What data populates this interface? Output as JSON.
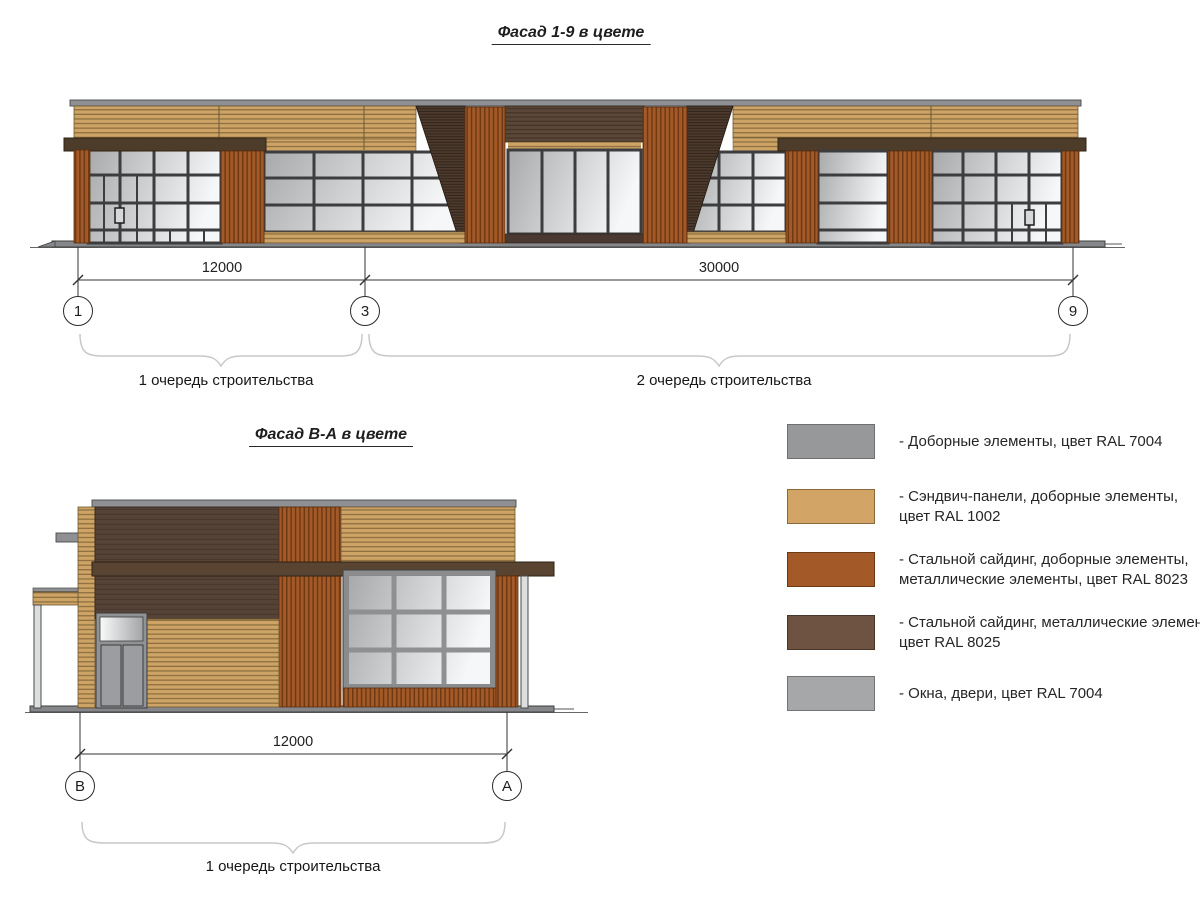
{
  "titles": {
    "facade_main": "Фасад 1-9 в цвете",
    "facade_side": "Фасад В-А в цвете"
  },
  "facade_main": {
    "dim_1_3": "12000",
    "dim_3_9": "30000",
    "axis_1": "1",
    "axis_3": "3",
    "axis_9": "9",
    "phase_1": "1 очередь строительства",
    "phase_2": "2 очередь строительства"
  },
  "facade_side": {
    "dim_b_a": "12000",
    "axis_b": "В",
    "axis_a": "А",
    "phase_1": "1 очередь строительства"
  },
  "legend": {
    "items": [
      {
        "color": "#97989a",
        "border": "#6e6f71",
        "lines": [
          "- Доборные элементы, цвет RAL 7004",
          ""
        ]
      },
      {
        "color": "#d2a566",
        "border": "#8a6a3c",
        "lines": [
          "- Сэндвич-панели, доборные элементы,",
          "цвет RAL 1002"
        ]
      },
      {
        "color": "#a45a28",
        "border": "#6e3a14",
        "lines": [
          "- Стальной сайдинг, доборные элементы,",
          "металлические элементы, цвет RAL 8023"
        ]
      },
      {
        "color": "#6e5342",
        "border": "#4a372b",
        "lines": [
          "- Стальной сайдинг, металлические элементы,",
          "цвет RAL 8025"
        ]
      },
      {
        "color": "#a6a7a9",
        "border": "#737476",
        "lines": [
          "- Окна, двери, цвет RAL 7004",
          ""
        ]
      }
    ]
  }
}
